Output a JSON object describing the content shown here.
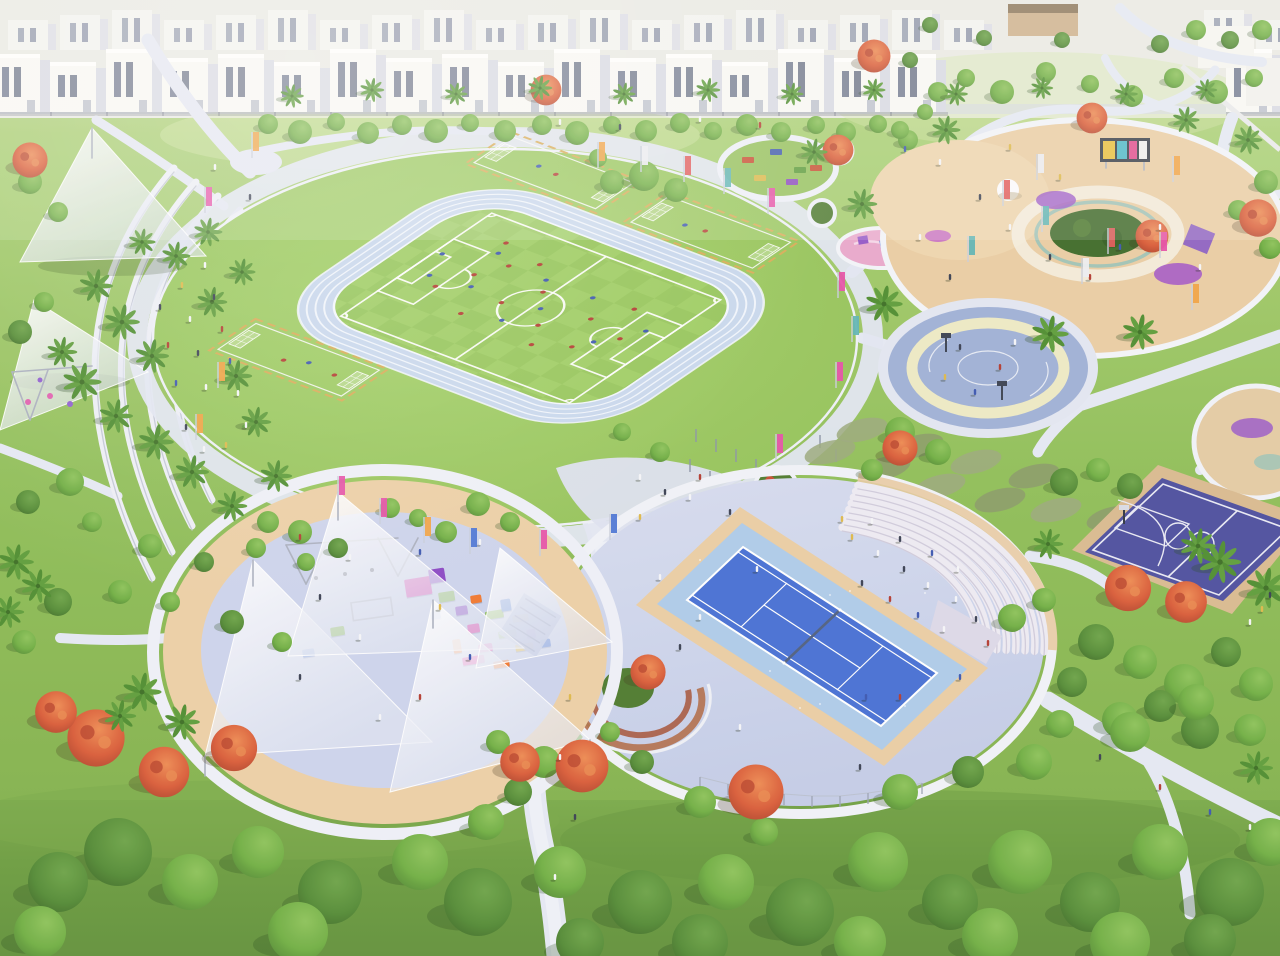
{
  "meta": {
    "title": "Aerial rendering of a community sports park with athletics field, tennis court, basketball courts and playgrounds",
    "type": "architectural-rendering",
    "view": "aerial-oblique"
  },
  "palette": {
    "grass-top": "#c6dc9a",
    "grass-mid": "#9fca68",
    "grass-low": "#85b650",
    "grass-bottom": "#6b9c40",
    "circle-grass": "#9ccb60",
    "pitch-a": "#9bcf63",
    "pitch-b": "#91c45a",
    "track": "#c8d8ee",
    "lane": "#f3f7fd",
    "path": "#e4e8f4",
    "plaza": "#ccd3eb",
    "step": "#edeaf3",
    "step-shade": "#cfcbdc",
    "tan": "#e9cda4",
    "sand": "#eed5ae",
    "tennis-court": "#466fd4",
    "tennis-apron": "#adcbe9",
    "bball-surface": "#9fb0d6",
    "ring-yellow": "#ece9c4",
    "purple-court": "#4c4f9f",
    "court-border-tan": "#d9ba90",
    "sail-white": "#ffffff",
    "house-white": "#f8f8f5",
    "house-side": "#d8dae3",
    "window-dark": "#5f6980",
    "road": "#d6dae1",
    "tree-green": "#6fae43",
    "tree-dark": "#548c36",
    "palm-green": "#4d8d30",
    "flower-red": "#d95c38",
    "net-dark": "#4f5f80",
    "accent-pink": "#e550a8",
    "accent-orange": "#f0a244",
    "accent-teal": "#5fb4b4",
    "accent-purple": "#9458c8",
    "accent-blue": "#4a74d4",
    "accent-yellow": "#e8c040"
  },
  "areas": [
    {
      "id": "housing-row",
      "label": "Townhouse row"
    },
    {
      "id": "athletics-circle",
      "label": "Circular athletics lawn"
    },
    {
      "id": "running-track",
      "label": "Running track"
    },
    {
      "id": "soccer-pitch",
      "label": "Soccer pitch"
    },
    {
      "id": "practice-pitches",
      "label": "Mini practice pitches"
    },
    {
      "id": "terraced-seating",
      "label": "Terraced lawn seating"
    },
    {
      "id": "shade-canopies",
      "label": "Shade canopies"
    },
    {
      "id": "picnic-circle",
      "label": "Picnic tables circle"
    },
    {
      "id": "toddler-playground-plaza",
      "label": "Sand playground plaza"
    },
    {
      "id": "basketball-circle",
      "label": "Circular basketball play court"
    },
    {
      "id": "amphitheater-steps",
      "label": "Amphitheatre steps"
    },
    {
      "id": "tennis-court",
      "label": "Tennis court"
    },
    {
      "id": "purple-basketball-court",
      "label": "Basketball court"
    },
    {
      "id": "sails-playground",
      "label": "Shaded sails playground"
    },
    {
      "id": "tree-layer",
      "label": "Park trees and palms"
    }
  ]
}
